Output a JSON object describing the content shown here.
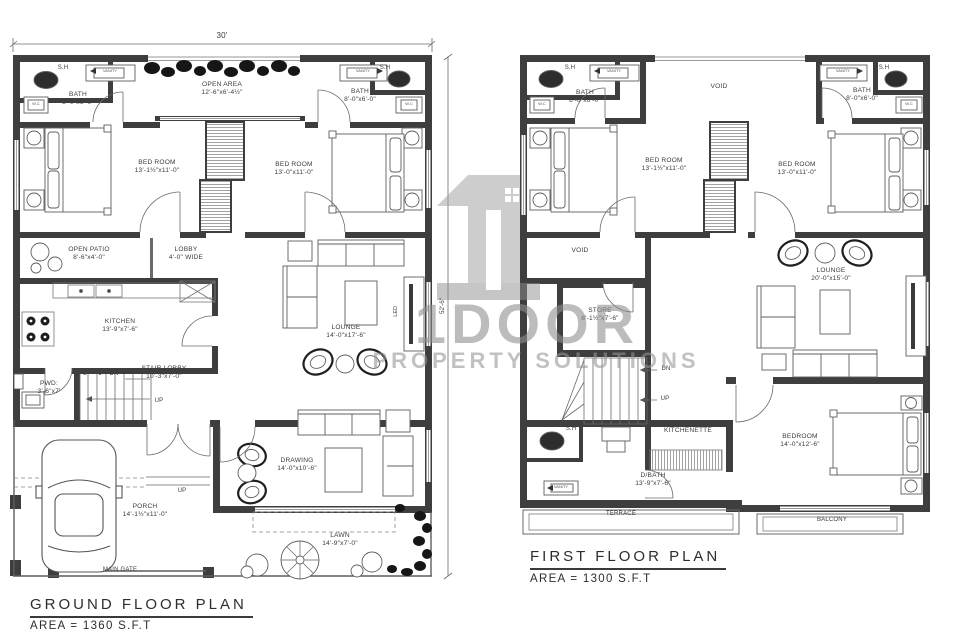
{
  "watermark": {
    "brand": "1DOOR",
    "tagline": "PROPERTY SOLUTIONS"
  },
  "ground_floor": {
    "title": "GROUND FLOOR PLAN",
    "area_note": "AREA = 1360 S.F.T",
    "dimensions": {
      "overall_width": "30'",
      "overall_height": "52'-6\""
    },
    "rooms": {
      "bath_left": {
        "label": "BATH",
        "size": "8'-0\"x6'-0\""
      },
      "open_area": {
        "label": "OPEN AREA",
        "size": "12'-6\"x6'-4½\""
      },
      "bath_right": {
        "label": "BATH",
        "size": "8'-0\"x6'-0\""
      },
      "bedroom_left": {
        "label": "BED ROOM",
        "size": "13'-1½\"x11'-0\""
      },
      "bedroom_right": {
        "label": "BED ROOM",
        "size": "13'-0\"x11'-0\""
      },
      "open_patio": {
        "label": "OPEN PATIO",
        "size": "8'-6\"x4'-0\""
      },
      "lobby": {
        "label": "LOBBY",
        "size": "4'-0\" WIDE"
      },
      "kitchen": {
        "label": "KITCHEN",
        "size": "13'-9\"x7'-6\""
      },
      "stair_lobby": {
        "label": "STAIR LOBBY",
        "size": "10'-3\"x7'-0\""
      },
      "pwd": {
        "label": "PWD:",
        "size": "3'-6\"x7'"
      },
      "lounge": {
        "label": "LOUNGE",
        "size": "14'-0\"x17'-6\""
      },
      "drawing_room": {
        "label": "DRAWING",
        "size": "14'-0\"x10'-6\""
      },
      "porch": {
        "label": "PORCH",
        "size": "14'-1½\"x11'-0\""
      },
      "lawn": {
        "label": "LAWN",
        "size": "14'-9\"x7'-0\""
      }
    },
    "annotations": {
      "shower_left": "S.H",
      "shower_right": "S.H",
      "vanity_left": "VANITY",
      "vanity_right": "VANITY",
      "wc_left": "W.C",
      "wc_right": "W.C",
      "stair_flight_2": "2",
      "stair_flight_1": "1",
      "down": "DN",
      "up_stair": "UP",
      "up_porch": "UP",
      "tv": "LED",
      "main_gate": "MAIN GATE"
    }
  },
  "first_floor": {
    "title": "FIRST FLOOR PLAN",
    "area_note": "AREA = 1300 S.F.T",
    "rooms": {
      "bath_left": {
        "label": "BATH",
        "size": "8'-0\"x6'-0\""
      },
      "void_top": {
        "label": "VOID"
      },
      "bath_right": {
        "label": "BATH",
        "size": "8'-0\"x6'-0\""
      },
      "bedroom_left": {
        "label": "BED ROOM",
        "size": "13'-1½\"x11'-0\""
      },
      "bedroom_right": {
        "label": "BED ROOM",
        "size": "13'-0\"x11'-0\""
      },
      "void_mid": {
        "label": "VOID"
      },
      "store": {
        "label": "STORE",
        "size": "8'-1½\"x7'-6\""
      },
      "lounge": {
        "label": "LOUNGE",
        "size": "20'-0\"x15'-0\""
      },
      "kitchenette": {
        "label": "KITCHENETTE"
      },
      "d_bath": {
        "label": "D/BATH",
        "size": "13'-9\"x7'-6\""
      },
      "bedroom_bottom": {
        "label": "BEDROOM",
        "size": "14'-0\"x12'-6\""
      },
      "terrace": {
        "label": "TERRACE"
      },
      "balcony": {
        "label": "BALCONY"
      }
    },
    "annotations": {
      "shower_left": "S.H",
      "shower_right": "S.H",
      "shower_bottom": "S.H",
      "vanity_left": "VANITY",
      "vanity_right": "VANITY",
      "vanity_bottom": "VANITY",
      "wc_left": "W.C",
      "wc_right": "W.C",
      "down": "DN",
      "up": "UP"
    }
  }
}
